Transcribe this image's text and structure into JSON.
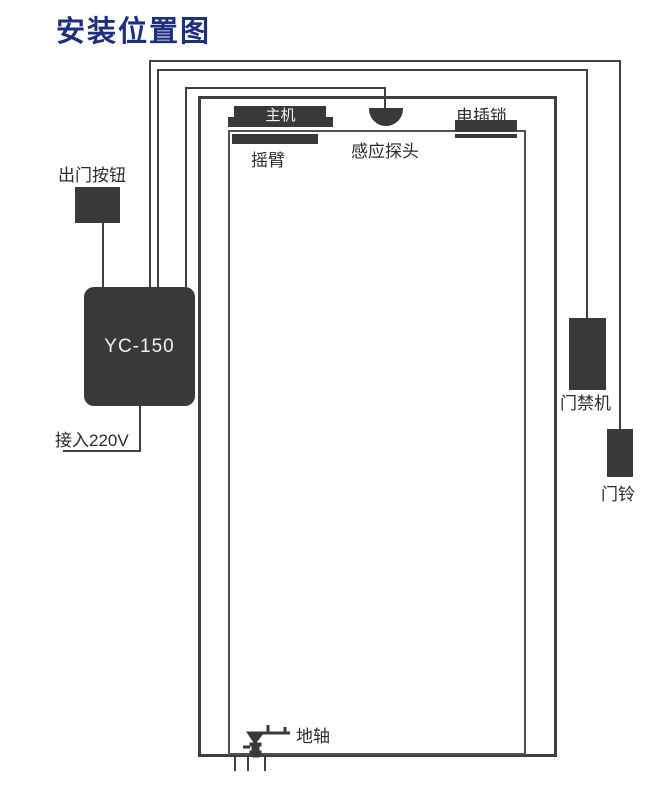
{
  "title": "安装位置图",
  "colors": {
    "background": "#ffffff",
    "title": "#1c2f80",
    "component": "#39393b",
    "wire": "#404042",
    "frame": "#3f3f41",
    "leaf": "#515153",
    "label": "#2b2b2d"
  },
  "components": {
    "exit_button": {
      "label": "出门按钮"
    },
    "controller": {
      "model": "YC-150"
    },
    "power": {
      "label": "接入220V"
    },
    "main_unit": {
      "label": "主机"
    },
    "swing_arm": {
      "label": "摇臂"
    },
    "sensor": {
      "label": "感应探头"
    },
    "electric_lock": {
      "label": "电插锁"
    },
    "access_control": {
      "label": "门禁机"
    },
    "doorbell": {
      "label": "门铃"
    },
    "floor_pivot": {
      "label": "地轴"
    }
  }
}
